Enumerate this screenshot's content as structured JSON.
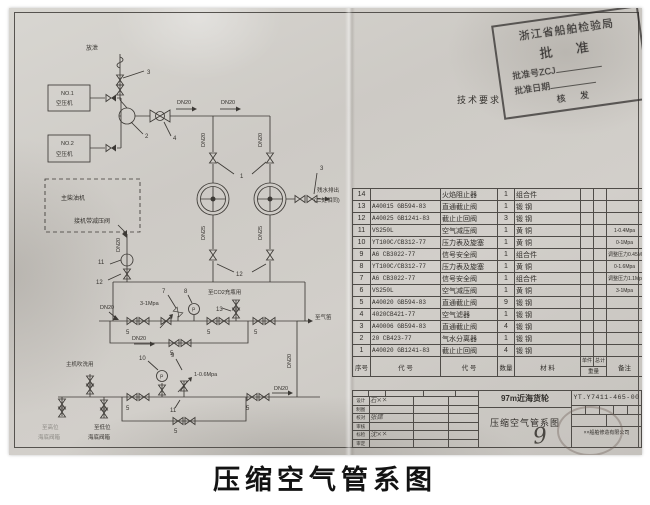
{
  "caption": "压缩空气管系图",
  "stamp": {
    "line1": "浙江省船舶检验局",
    "line2": "批  准",
    "line3": "批准号ZCJ",
    "line4": "批准日期",
    "line5": "核  发"
  },
  "tech_requirements": {
    "title": "技术要求",
    "lines": [
      "1、管子材料： 压力表管和放泄管为φ10×2紫铜管外，其余为",
      "    无缝钢管  DN20   φ27×3.5     DN25   φ34×3.5",
      "2、管子压力试验： 各管段应按相应工作压力的1.5倍",
      "              进行密性试验.",
      "3、管子应镀锌.",
      "4、管子连接采用CB822-84螺纹连接."
    ]
  },
  "parts_table": {
    "header": {
      "no": "序号",
      "code": "代    号",
      "name": "代    号",
      "qty": "数量",
      "material": "材  料",
      "w_unit": "单件",
      "w_total": "总计",
      "w_label": "重量",
      "remark": "备注"
    },
    "rows": [
      {
        "no": "14",
        "code": "",
        "name": "火焰阻止器",
        "qty": "1",
        "mat": "组合件",
        "remark": ""
      },
      {
        "no": "13",
        "code": "A40015 GB594-83",
        "name": "直通截止阀",
        "qty": "1",
        "mat": "锻  钢",
        "remark": ""
      },
      {
        "no": "12",
        "code": "A40025 GB1241-83",
        "name": "截止止回阀",
        "qty": "3",
        "mat": "锻  钢",
        "remark": ""
      },
      {
        "no": "11",
        "code": "VS250L",
        "name": "空气减压阀",
        "qty": "1",
        "mat": "黄  铜",
        "remark": "1-0.4Mpa"
      },
      {
        "no": "10",
        "code": "YT100C/CB312-77",
        "name": "压力表及旋塞",
        "qty": "1",
        "mat": "黄  铜",
        "remark": "0-1Mpa"
      },
      {
        "no": "9",
        "code": "A6 CB3022-77",
        "name": "信号安全阀",
        "qty": "1",
        "mat": "组合件",
        "remark": "调整压力0.45Mpa"
      },
      {
        "no": "8",
        "code": "YT100C/CB312-77",
        "name": "压力表及旋塞",
        "qty": "1",
        "mat": "黄  铜",
        "remark": "0-1.6Mpa"
      },
      {
        "no": "7",
        "code": "A6 CB3022-77",
        "name": "信号安全阀",
        "qty": "1",
        "mat": "组合件",
        "remark": "调整压力1.1Mpa"
      },
      {
        "no": "6",
        "code": "VS250L",
        "name": "空气减压阀",
        "qty": "1",
        "mat": "黄  铜",
        "remark": "3-1Mpa"
      },
      {
        "no": "5",
        "code": "A40020 GB594-83",
        "name": "直通截止阀",
        "qty": "9",
        "mat": "锻  钢",
        "remark": ""
      },
      {
        "no": "4",
        "code": "4020CB421-77",
        "name": "空气滤器",
        "qty": "1",
        "mat": "锻  钢",
        "remark": ""
      },
      {
        "no": "3",
        "code": "A40006 GB594-83",
        "name": "直通截止阀",
        "qty": "4",
        "mat": "锻  钢",
        "remark": ""
      },
      {
        "no": "2",
        "code": "20 CB423-77",
        "name": "气水分离器",
        "qty": "1",
        "mat": "锻  钢",
        "remark": ""
      },
      {
        "no": "1",
        "code": "A40020 GB1241-83",
        "name": "截止止回阀",
        "qty": "4",
        "mat": "锻  钢",
        "remark": ""
      }
    ]
  },
  "title_block": {
    "ship": "97m近海货轮",
    "title": "压缩空气管系图",
    "page_hand": "9",
    "drawing_no": "YT.Y7411-465-00",
    "company": "××船舶修造有限公司",
    "sig_header": [
      "标记",
      "数量",
      "修改单号",
      "签 字",
      "日期"
    ],
    "sig_rows": [
      {
        "label": "设计",
        "name": "石××"
      },
      {
        "label": "制图",
        "name": ""
      },
      {
        "label": "校对",
        "name": "张建"
      },
      {
        "label": "审核",
        "name": ""
      },
      {
        "label": "标检",
        "name": "沈××"
      },
      {
        "label": "审定",
        "name": ""
      }
    ]
  },
  "diagram": {
    "vent": "放泄",
    "no1": "NO.1",
    "no2": "NO.2",
    "compressor": "空压机",
    "dn20": "DN20",
    "dn25": "DN25",
    "main_engine": "主柴油机",
    "reducer_label": "接机带减压阀",
    "drain1": "残水排出",
    "drain2": "(二处相同)",
    "co2": "至CO2充瓶用",
    "whistle": "至气笛",
    "p31": "3-1Mpa",
    "p106": "1-0.6Mpa",
    "blow": "主机吹洗用",
    "high1": "至高位",
    "low1": "至低位",
    "chest": "海底阀箱",
    "gauge": "P",
    "nums": {
      "n1": "1",
      "n2": "2",
      "n3": "3",
      "n4": "4",
      "n5": "5",
      "n7": "7",
      "n8": "8",
      "n9": "9",
      "n10": "10",
      "n11": "11",
      "n12": "12",
      "n13": "13"
    }
  }
}
